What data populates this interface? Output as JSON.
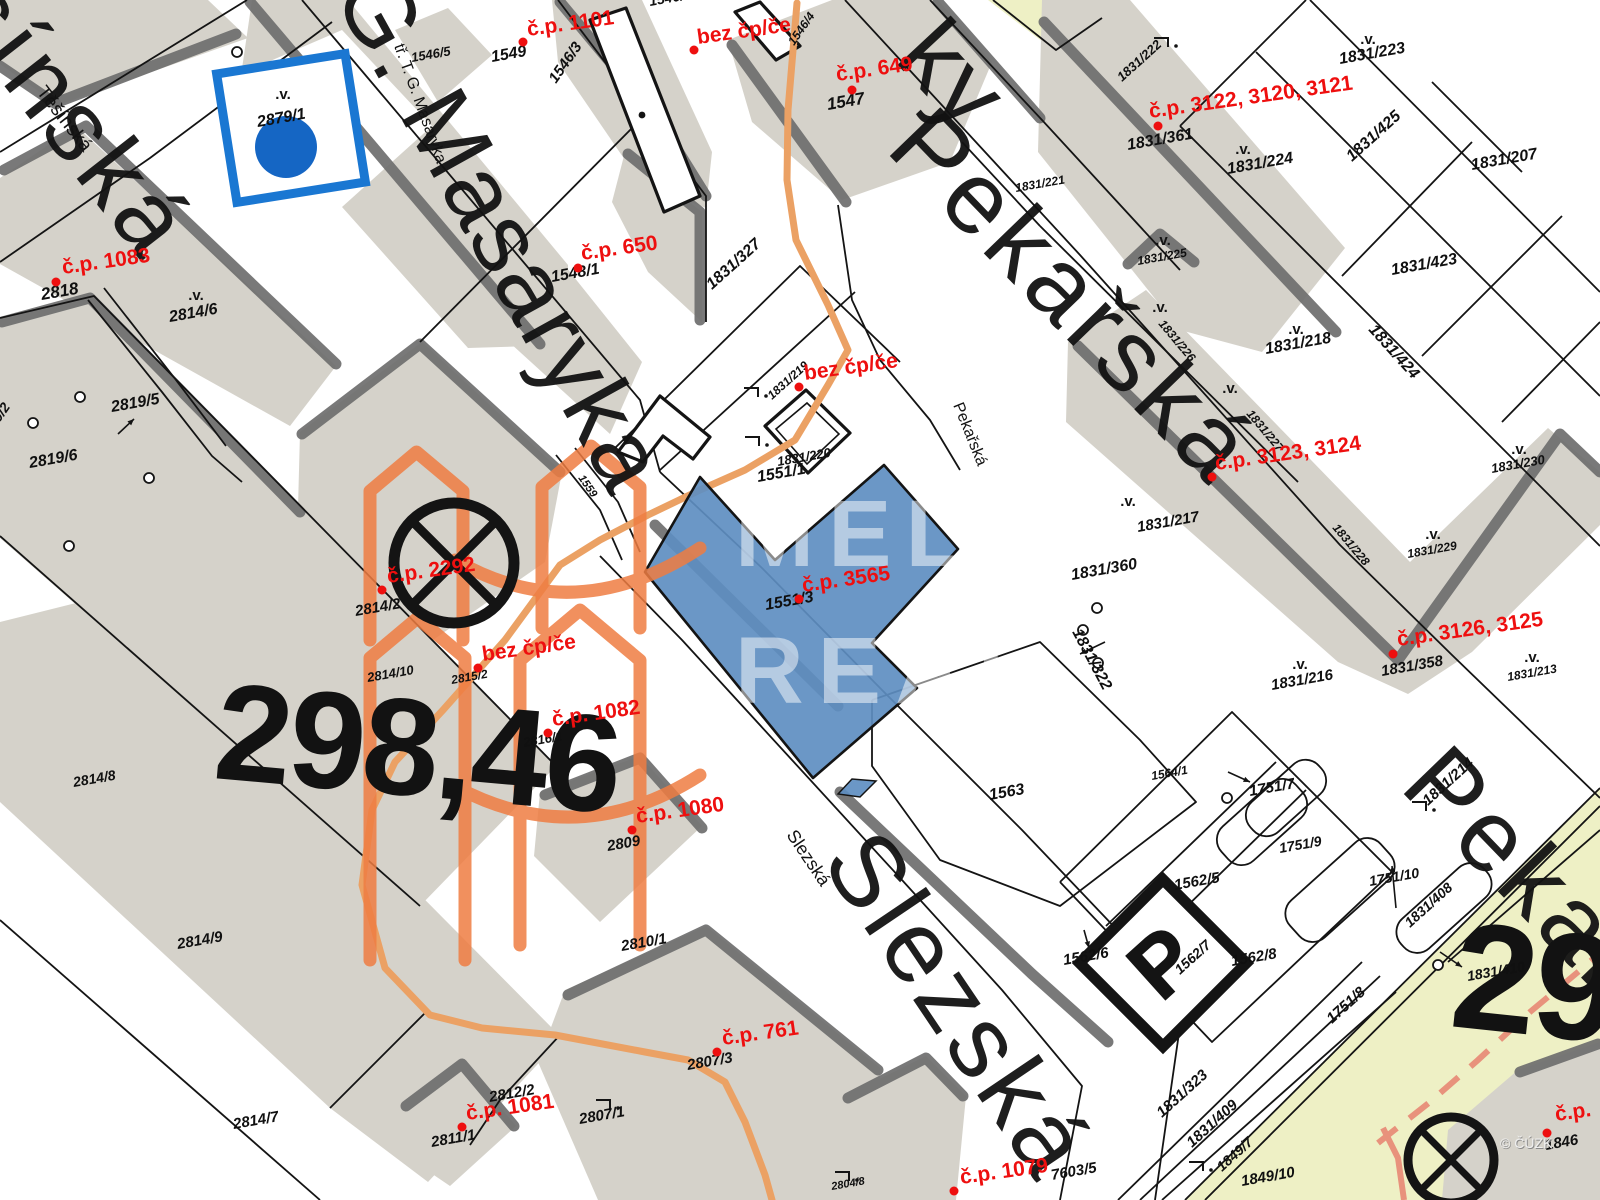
{
  "map": {
    "title": "Katastrální mapa",
    "highlighted_parcel": "1551/3",
    "colors": {
      "background": "#ffffff",
      "block_fill": "#d5d2ca",
      "block_shadow": "#6e6e6e",
      "line": "#141414",
      "parcel_text": "#101010",
      "address_text": "#ee0f0f",
      "street_text": "#121212",
      "highlight_fill": "#5e8ec1",
      "marker_blue_stroke": "#1a77d2",
      "marker_blue_fill": "#1566c4",
      "utility_orange": "#eba164",
      "utility_salmon": "#e8927c",
      "landuse_yellow": "#eef0c5",
      "watermark_orange": "#ef7d42",
      "watermark_text": "#ffffff",
      "copyright_text": "#efefef"
    },
    "street_names_large": [
      {
        "label": "šínská",
        "x": -55,
        "y": 10,
        "rotation": 52,
        "size": 100,
        "spacing": 6
      },
      {
        "label": "G. Masaryka",
        "x": 332,
        "y": -6,
        "rotation": 61,
        "size": 98,
        "spacing": 2
      },
      {
        "label": "ky",
        "x": 893,
        "y": 60,
        "rotation": 47,
        "size": 100,
        "spacing": 2
      },
      {
        "label": "Pekařská",
        "x": 884,
        "y": 150,
        "rotation": 46,
        "size": 102,
        "spacing": 6
      },
      {
        "label": "Slezská",
        "x": 820,
        "y": 862,
        "rotation": 56,
        "size": 102,
        "spacing": 5
      },
      {
        "label": "Pekařská",
        "x": 1398,
        "y": 788,
        "rotation": 46,
        "size": 102,
        "spacing": 6
      }
    ],
    "street_names_small": [
      {
        "label": "Těšínská",
        "x": 36,
        "y": 92,
        "rotation": 52,
        "size": 19
      },
      {
        "label": "tř. T. G. Masaryka",
        "x": 394,
        "y": 46,
        "rotation": 70,
        "size": 16
      },
      {
        "label": "Pekařská",
        "x": 953,
        "y": 405,
        "rotation": 68,
        "size": 16
      },
      {
        "label": "Slezská",
        "x": 786,
        "y": 835,
        "rotation": 56,
        "size": 18
      }
    ],
    "parcel_labels": [
      {
        "label": "2818",
        "x": 42,
        "y": 300,
        "rotation": -10,
        "size": 17
      },
      {
        "label": "2814/6",
        "x": 170,
        "y": 322,
        "rotation": -10,
        "size": 16
      },
      {
        "label": "2819/5",
        "x": 112,
        "y": 412,
        "rotation": -10,
        "size": 16
      },
      {
        "label": "2819/6",
        "x": 30,
        "y": 468,
        "rotation": -10,
        "size": 16
      },
      {
        "label": "2819/2",
        "x": -14,
        "y": 442,
        "rotation": -55,
        "size": 14
      },
      {
        "label": "2879/1",
        "x": 258,
        "y": 127,
        "rotation": -10,
        "size": 16
      },
      {
        "label": "1549",
        "x": 492,
        "y": 62,
        "rotation": -10,
        "size": 16
      },
      {
        "label": "1546/5",
        "x": 412,
        "y": 62,
        "rotation": -10,
        "size": 13
      },
      {
        "label": "1546/3",
        "x": 556,
        "y": 84,
        "rotation": -55,
        "size": 15
      },
      {
        "label": "1546/4",
        "x": 794,
        "y": 46,
        "rotation": -55,
        "size": 12
      },
      {
        "label": "1546/2",
        "x": 650,
        "y": 6,
        "rotation": -10,
        "size": 14
      },
      {
        "label": "1547",
        "x": 828,
        "y": 110,
        "rotation": -10,
        "size": 17
      },
      {
        "label": "1548/1",
        "x": 552,
        "y": 282,
        "rotation": -10,
        "size": 16
      },
      {
        "label": "1831/327",
        "x": 712,
        "y": 290,
        "rotation": -42,
        "size": 16
      },
      {
        "label": "1831/222",
        "x": 1122,
        "y": 82,
        "rotation": -42,
        "size": 13
      },
      {
        "label": "1831/223",
        "x": 1340,
        "y": 64,
        "rotation": -10,
        "size": 16
      },
      {
        "label": "1831/361",
        "x": 1128,
        "y": 150,
        "rotation": -10,
        "size": 16
      },
      {
        "label": "1831/224",
        "x": 1228,
        "y": 174,
        "rotation": -10,
        "size": 16
      },
      {
        "label": "1831/425",
        "x": 1352,
        "y": 162,
        "rotation": -42,
        "size": 16
      },
      {
        "label": "1831/207",
        "x": 1472,
        "y": 170,
        "rotation": -10,
        "size": 16
      },
      {
        "label": "1831/423",
        "x": 1392,
        "y": 275,
        "rotation": -10,
        "size": 16
      },
      {
        "label": "1831/424",
        "x": 1368,
        "y": 330,
        "rotation": 48,
        "size": 16
      },
      {
        "label": "1831/225",
        "x": 1138,
        "y": 265,
        "rotation": -10,
        "size": 12
      },
      {
        "label": "1831/221",
        "x": 1016,
        "y": 192,
        "rotation": -10,
        "size": 12
      },
      {
        "label": "1831/218",
        "x": 1266,
        "y": 354,
        "rotation": -10,
        "size": 16
      },
      {
        "label": "1831/219",
        "x": 772,
        "y": 400,
        "rotation": -42,
        "size": 12
      },
      {
        "label": "1831/220",
        "x": 778,
        "y": 466,
        "rotation": -10,
        "size": 13
      },
      {
        "label": "1551/1",
        "x": 758,
        "y": 482,
        "rotation": -10,
        "size": 16
      },
      {
        "label": "1559",
        "x": 578,
        "y": 478,
        "rotation": 55,
        "size": 11
      },
      {
        "label": "1551/3",
        "x": 766,
        "y": 610,
        "rotation": -10,
        "size": 16
      },
      {
        "label": "1831/322",
        "x": 1072,
        "y": 632,
        "rotation": 62,
        "size": 16
      },
      {
        "label": "1564/1",
        "x": 1152,
        "y": 780,
        "rotation": -10,
        "size": 12
      },
      {
        "label": "1563",
        "x": 990,
        "y": 800,
        "rotation": -10,
        "size": 16
      },
      {
        "label": "1831/360",
        "x": 1072,
        "y": 580,
        "rotation": -10,
        "size": 16
      },
      {
        "label": "1831/217",
        "x": 1138,
        "y": 532,
        "rotation": -10,
        "size": 15
      },
      {
        "label": "1831/226",
        "x": 1158,
        "y": 324,
        "rotation": 50,
        "size": 12
      },
      {
        "label": "1831/227",
        "x": 1246,
        "y": 414,
        "rotation": 50,
        "size": 12
      },
      {
        "label": "1831/228",
        "x": 1332,
        "y": 528,
        "rotation": 50,
        "size": 12
      },
      {
        "label": "1831/229",
        "x": 1408,
        "y": 558,
        "rotation": -10,
        "size": 12
      },
      {
        "label": "1831/230",
        "x": 1492,
        "y": 473,
        "rotation": -10,
        "size": 13
      },
      {
        "label": "1831/216",
        "x": 1272,
        "y": 690,
        "rotation": -10,
        "size": 15
      },
      {
        "label": "1831/358",
        "x": 1382,
        "y": 676,
        "rotation": -10,
        "size": 15
      },
      {
        "label": "1831/213",
        "x": 1508,
        "y": 681,
        "rotation": -10,
        "size": 12
      },
      {
        "label": "1831/214",
        "x": 1428,
        "y": 806,
        "rotation": -42,
        "size": 15
      },
      {
        "label": "1751/7",
        "x": 1250,
        "y": 796,
        "rotation": -10,
        "size": 15
      },
      {
        "label": "1751/9",
        "x": 1280,
        "y": 853,
        "rotation": -10,
        "size": 14
      },
      {
        "label": "1751/10",
        "x": 1370,
        "y": 886,
        "rotation": -10,
        "size": 14
      },
      {
        "label": "1562/5",
        "x": 1175,
        "y": 890,
        "rotation": -10,
        "size": 15
      },
      {
        "label": "1562/6",
        "x": 1064,
        "y": 965,
        "rotation": -10,
        "size": 15
      },
      {
        "label": "1562/7",
        "x": 1180,
        "y": 975,
        "rotation": -42,
        "size": 14
      },
      {
        "label": "1562/8",
        "x": 1232,
        "y": 966,
        "rotation": -10,
        "size": 15
      },
      {
        "label": "1751/8",
        "x": 1332,
        "y": 1024,
        "rotation": -42,
        "size": 15
      },
      {
        "label": "1831/323",
        "x": 1162,
        "y": 1118,
        "rotation": -42,
        "size": 15
      },
      {
        "label": "1831/409",
        "x": 1192,
        "y": 1148,
        "rotation": -42,
        "size": 15
      },
      {
        "label": "1849/7",
        "x": 1222,
        "y": 1172,
        "rotation": -42,
        "size": 14
      },
      {
        "label": "1849/10",
        "x": 1242,
        "y": 1186,
        "rotation": -10,
        "size": 15
      },
      {
        "label": "7603/5",
        "x": 1052,
        "y": 1180,
        "rotation": -10,
        "size": 15
      },
      {
        "label": "2804/8",
        "x": 832,
        "y": 1190,
        "rotation": -10,
        "size": 11
      },
      {
        "label": "1831/408",
        "x": 1410,
        "y": 928,
        "rotation": -42,
        "size": 14
      },
      {
        "label": "1831/410",
        "x": 1468,
        "y": 981,
        "rotation": -10,
        "size": 14
      },
      {
        "label": "1846",
        "x": 1546,
        "y": 1150,
        "rotation": -10,
        "size": 15
      },
      {
        "label": "2814/2",
        "x": 356,
        "y": 616,
        "rotation": -10,
        "size": 15
      },
      {
        "label": "2814/10",
        "x": 368,
        "y": 682,
        "rotation": -10,
        "size": 13
      },
      {
        "label": "2815/2",
        "x": 452,
        "y": 684,
        "rotation": -10,
        "size": 12
      },
      {
        "label": "2816/1",
        "x": 524,
        "y": 747,
        "rotation": -10,
        "size": 13
      },
      {
        "label": "2809",
        "x": 608,
        "y": 851,
        "rotation": -10,
        "size": 15
      },
      {
        "label": "2810/1",
        "x": 622,
        "y": 951,
        "rotation": -10,
        "size": 15
      },
      {
        "label": "2807/3",
        "x": 688,
        "y": 1070,
        "rotation": -10,
        "size": 15
      },
      {
        "label": "2807/1",
        "x": 580,
        "y": 1124,
        "rotation": -10,
        "size": 15
      },
      {
        "label": "2811/1",
        "x": 432,
        "y": 1147,
        "rotation": -10,
        "size": 15
      },
      {
        "label": "2812/2",
        "x": 490,
        "y": 1102,
        "rotation": -10,
        "size": 15
      },
      {
        "label": "2814/7",
        "x": 234,
        "y": 1129,
        "rotation": -10,
        "size": 15
      },
      {
        "label": "2814/8",
        "x": 74,
        "y": 787,
        "rotation": -10,
        "size": 14
      },
      {
        "label": "2814/9",
        "x": 178,
        "y": 949,
        "rotation": -10,
        "size": 15
      }
    ],
    "address_labels": [
      {
        "label": "č.p. 1083",
        "x": 63,
        "y": 274,
        "rotation": -8,
        "dot_x": 56,
        "dot_y": 282
      },
      {
        "label": "č.p. 1101",
        "x": 528,
        "y": 36,
        "rotation": -8,
        "dot_x": 523,
        "dot_y": 42
      },
      {
        "label": "bez čp/če",
        "x": 698,
        "y": 44,
        "rotation": -8,
        "dot_x": 694,
        "dot_y": 50
      },
      {
        "label": "č.p. 649",
        "x": 837,
        "y": 81,
        "rotation": -8,
        "dot_x": 852,
        "dot_y": 90
      },
      {
        "label": "č.p. 650",
        "x": 582,
        "y": 260,
        "rotation": -8,
        "dot_x": 578,
        "dot_y": 268
      },
      {
        "label": "bez čp/če",
        "x": 805,
        "y": 380,
        "rotation": -8,
        "dot_x": 799,
        "dot_y": 387
      },
      {
        "label": "č.p. 3122, 3120, 3121",
        "x": 1150,
        "y": 118,
        "rotation": -8,
        "dot_x": 1158,
        "dot_y": 126
      },
      {
        "label": "č.p. 3123, 3124",
        "x": 1216,
        "y": 470,
        "rotation": -8,
        "dot_x": 1212,
        "dot_y": 477
      },
      {
        "label": "č.p. 3126, 3125",
        "x": 1398,
        "y": 646,
        "rotation": -8,
        "dot_x": 1393,
        "dot_y": 654
      },
      {
        "label": "č.p. 3565",
        "x": 803,
        "y": 592,
        "rotation": -8,
        "dot_x": 799,
        "dot_y": 599
      },
      {
        "label": "č.p. 2292",
        "x": 388,
        "y": 583,
        "rotation": -8,
        "dot_x": 382,
        "dot_y": 590
      },
      {
        "label": "bez čp/če",
        "x": 483,
        "y": 661,
        "rotation": -8,
        "dot_x": 478,
        "dot_y": 668
      },
      {
        "label": "č.p. 1082",
        "x": 553,
        "y": 726,
        "rotation": -8,
        "dot_x": 548,
        "dot_y": 733
      },
      {
        "label": "č.p. 1080",
        "x": 637,
        "y": 823,
        "rotation": -8,
        "dot_x": 632,
        "dot_y": 830
      },
      {
        "label": "č.p. 761",
        "x": 723,
        "y": 1045,
        "rotation": -8,
        "dot_x": 717,
        "dot_y": 1052
      },
      {
        "label": "č.p. 1081",
        "x": 467,
        "y": 1120,
        "rotation": -8,
        "dot_x": 462,
        "dot_y": 1127
      },
      {
        "label": "č.p. 1079",
        "x": 961,
        "y": 1184,
        "rotation": -8,
        "dot_x": 954,
        "dot_y": 1191
      },
      {
        "label": "č.p.",
        "x": 1556,
        "y": 1121,
        "rotation": -8,
        "dot_x": 1547,
        "dot_y": 1133
      }
    ],
    "elevation_marks": [
      {
        "label": "298,46",
        "x": 212,
        "y": 778,
        "rotation": 5,
        "size": 138
      },
      {
        "label": "298",
        "x": 1448,
        "y": 1026,
        "rotation": 6,
        "size": 152
      }
    ],
    "map_symbols": {
      "parking_letter": "P",
      "survey_symbol": ".v."
    },
    "watermark": {
      "lines": [
        "MELK",
        "REAL"
      ],
      "copyright": "© ČÚZK"
    }
  }
}
